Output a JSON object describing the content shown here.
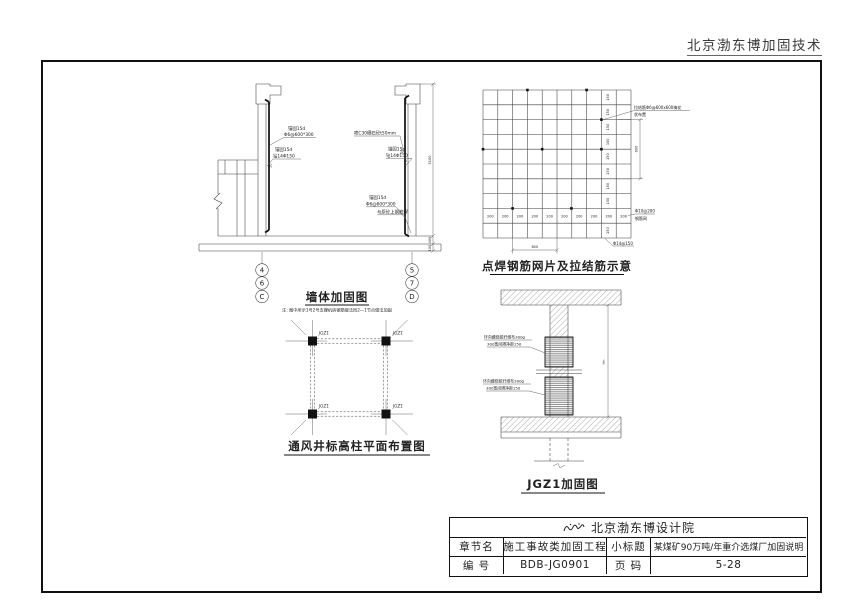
{
  "page": {
    "header_brand": "北京渤东博加固技术"
  },
  "wall_diagram": {
    "title": "墙体加固图",
    "note": "注: 图中所示1号2号支撑机房钢筋做法同2—1节点做法加固",
    "ann_left1_l1": "锚固15d",
    "ann_left1_l2": "Φ6@600*300",
    "ann_left2_l1": "锚固15d",
    "ann_left2_l2": "钻14Φ150",
    "ann_concrete": "喷C30细石砼t50mm",
    "ann_right1_l1": "锚固15d",
    "ann_right1_l2": "钻14Φ150",
    "ann_right2_l1": "锚固15d",
    "ann_right2_l2": "Φ6@600*300",
    "ann_weld": "与原砼上钢筋焊",
    "dim_5100": "5100",
    "dim_400": "400",
    "dim_100": "100",
    "dim_50": "50",
    "bubbles_left": [
      "4",
      "6",
      "C"
    ],
    "bubbles_right": [
      "5",
      "7",
      "D"
    ]
  },
  "mesh_diagram": {
    "title": "点焊钢筋网片及拉结筋示意",
    "ann_tie_l1": "拉结筋Φ6@600x600梅花",
    "ann_tie_l2": "状布置",
    "ann_mesh_l1": "Φ10@200",
    "ann_mesh_l2": "钢筋网",
    "ann_corner": "Φ14@150",
    "dim_150": "150",
    "dim_200": "200",
    "dim_600": "600"
  },
  "column_plan": {
    "title": "通风井标高柱平面布置图",
    "column_label": "JGZ1"
  },
  "jgz1_diagram": {
    "title": "JGZ1加固图",
    "ann_wrap_l1": "环向缠绕碳纤维布300g",
    "ann_wrap_l2": "300宽间隔净距150",
    "dim_h": "Hn"
  },
  "title_block": {
    "institute": "北京渤东博设计院",
    "row2": {
      "label1": "章节名",
      "value1": "施工事故类加固工程",
      "label2": "小标题",
      "value2": "某煤矿90万吨/年重介选煤厂加固说明"
    },
    "row3": {
      "label1": "编  号",
      "value1": "BDB-JG0901",
      "label2": "页  码",
      "value2": "5-28"
    }
  }
}
